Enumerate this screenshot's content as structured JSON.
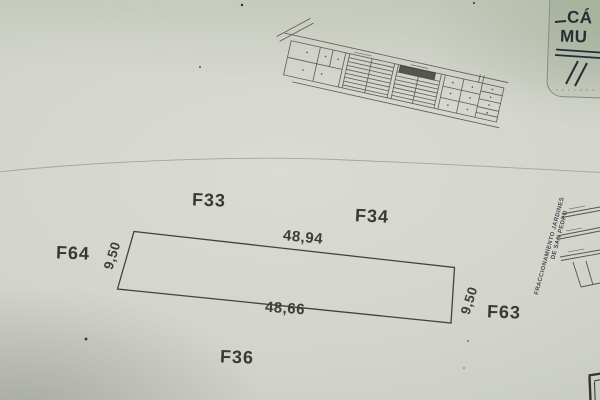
{
  "photo": {
    "paper_color": "#d3d5cc",
    "ink_color": "#3c3c36",
    "stamp_ink_color": "#272c38"
  },
  "stamp": {
    "line1": "CÁ",
    "line2": "MU",
    "microtext": "·  ·  ·  ·  ·  ·  ·"
  },
  "main_plan": {
    "lot_labels": {
      "top_left": "F33",
      "top_right": "F34",
      "left": "F64",
      "right": "F63",
      "bottom": "F36"
    },
    "dimensions": {
      "top": "48,94",
      "bottom": "48,66",
      "left": "9,50",
      "right": "9,50"
    }
  },
  "side_note": {
    "line1": "FRACCIONAMIENTO  JARDINES",
    "line2": "DE  SAN  PEDRO"
  }
}
